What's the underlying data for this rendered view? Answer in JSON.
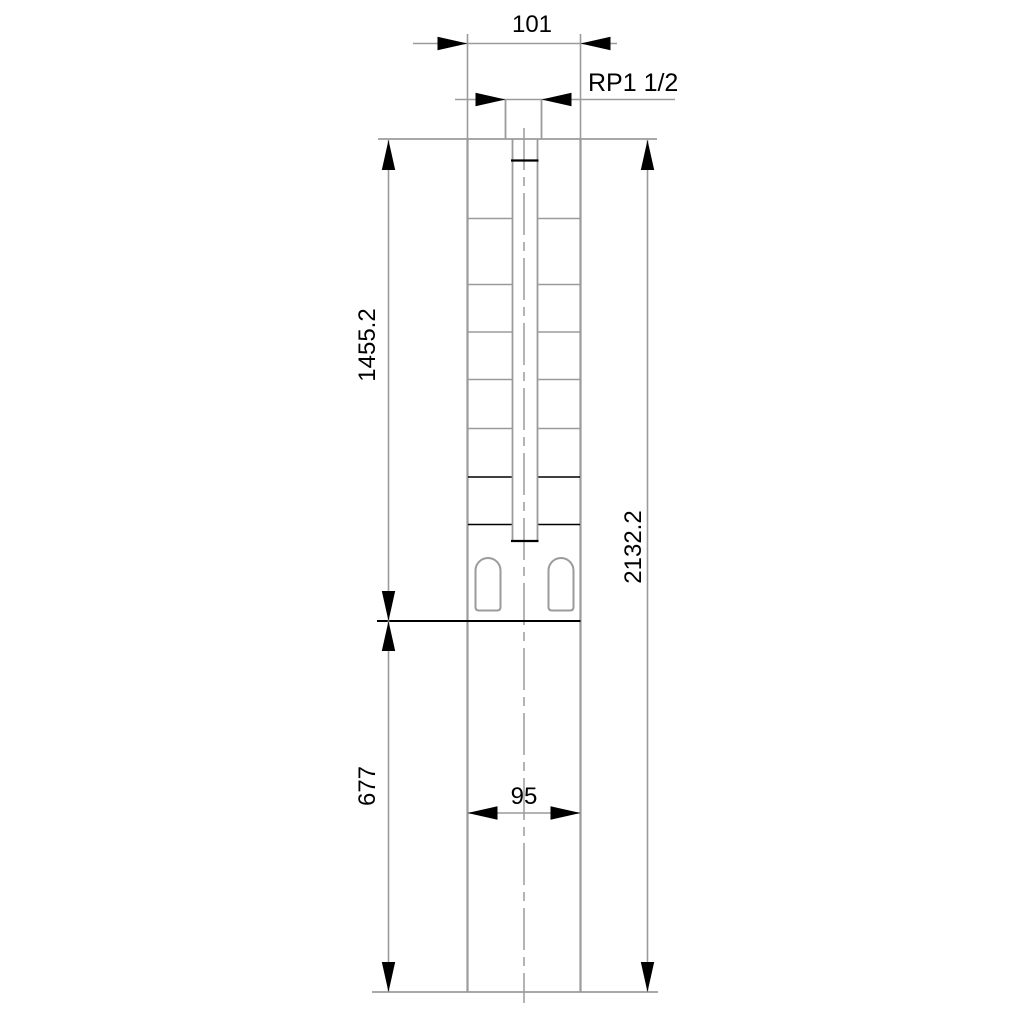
{
  "drawing": {
    "title": "Submersible pump dimensional outline drawing",
    "colors": {
      "background": "#ffffff",
      "line": "#9b9b9b",
      "accent": "#000000"
    },
    "labels": {
      "top_width": "101",
      "thread_connection": "RP1 1/2",
      "pump_length": "1455.2",
      "total_length": "2132.2",
      "motor_length": "677",
      "motor_width": "95"
    }
  }
}
